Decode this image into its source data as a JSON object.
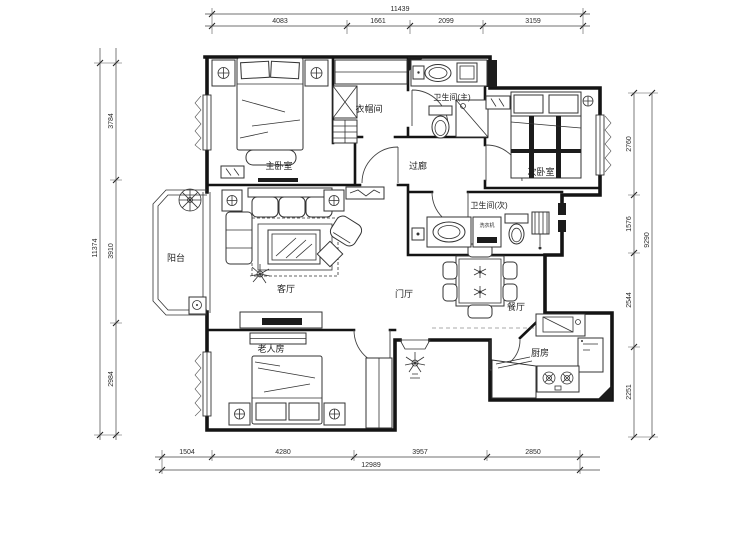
{
  "rooms": {
    "master_bedroom": "主卧室",
    "cloakroom": "衣帽间",
    "master_bath": "卫生间(主)",
    "second_bedroom": "次卧室",
    "corridor": "过廊",
    "balcony": "阳台",
    "living_room": "客厅",
    "entry_hall": "门厅",
    "dining_room": "餐厅",
    "second_bath": "卫生间(次)",
    "elder_room": "老人房",
    "kitchen": "厨房"
  },
  "fixtures": {
    "washing_machine": "洗衣机"
  },
  "dimensions": {
    "top": {
      "total": "11439",
      "segments": [
        "4083",
        "1661",
        "2099",
        "3159"
      ]
    },
    "bottom": {
      "total": "12989",
      "segments": [
        "1504",
        "4280",
        "3957",
        "2850"
      ]
    },
    "left": {
      "total": "11374",
      "segments": [
        "3784",
        "3910",
        "2984"
      ]
    },
    "right": {
      "total": "9290",
      "segments": [
        "2760",
        "1576",
        "2544",
        "2251"
      ]
    }
  },
  "colors": {
    "wall": "#141414",
    "line": "#333333",
    "background": "#ffffff"
  }
}
